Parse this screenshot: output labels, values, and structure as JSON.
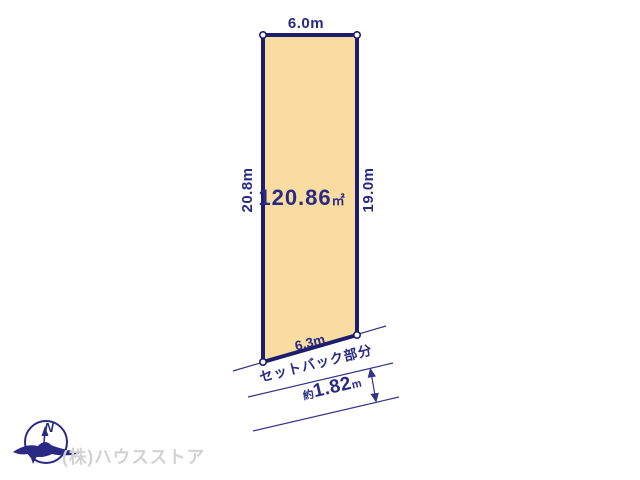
{
  "plot": {
    "top_dimension": "6.0m",
    "left_dimension": "20.8m",
    "right_dimension": "19.0m",
    "bottom_dimension": "6.3m",
    "area_value": "120.86",
    "area_unit": "㎡"
  },
  "setback": {
    "label": "セットバック部分",
    "approx_prefix": "約",
    "value": "1.82",
    "unit": "m"
  },
  "compass": {
    "north": "N"
  },
  "footer": {
    "company": "(株)ハウスストア"
  },
  "colors": {
    "plot_fill": "#f9dc9f",
    "plot_border": "#1d1d6e",
    "label_text": "#2a2a85",
    "thin_line": "#333388",
    "company_text": "#d2d2d2",
    "background": "#ffffff"
  }
}
